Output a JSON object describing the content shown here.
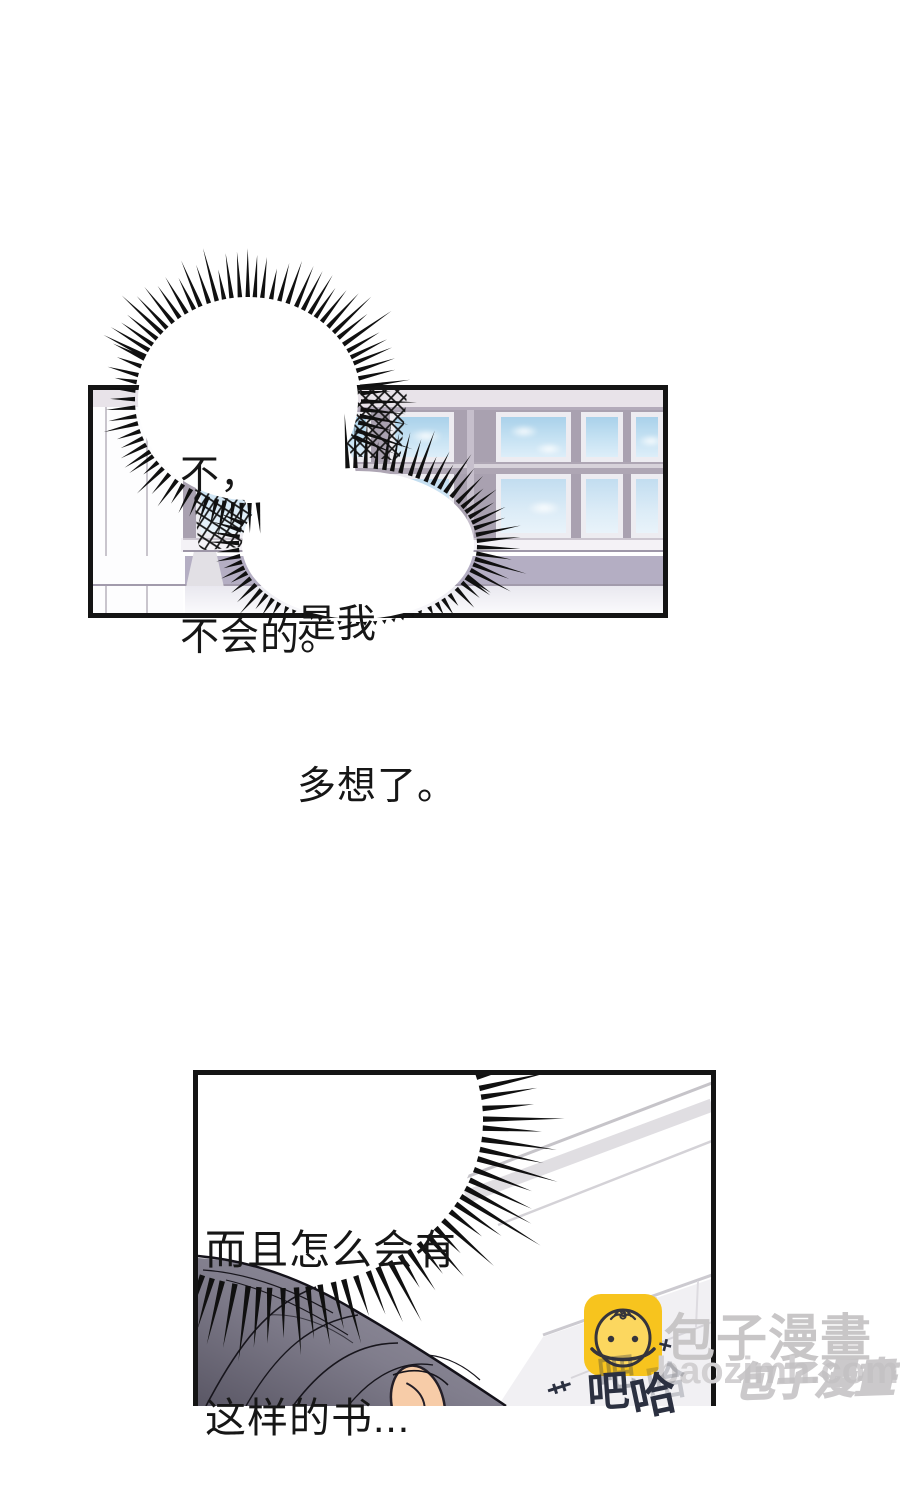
{
  "bubbles": {
    "b1": [
      "不，",
      "不会的。"
    ],
    "b2": [
      "是我",
      "多想了。"
    ],
    "b3": [
      "而且怎么会有",
      "这样的书..."
    ]
  },
  "sfx": {
    "laugh1": "吧",
    "laugh2": "哈",
    "plus_mark": "+",
    "scratch_mark": "艹"
  },
  "watermark": {
    "brand": "包子漫畫",
    "domain": "baozimh.com",
    "overlay": "包子漫畫",
    "icon": "baozi-bun-icon",
    "icon_color": "#f7c41e"
  },
  "colors": {
    "panel_border": "#141414",
    "ink": "#101010",
    "bubble": "#ffffff",
    "wall_light": "#e8e3e9",
    "window_frame": "#a9a1b0",
    "wainscot": "#b4aec3",
    "sky_top": "#a9d1ea",
    "sky_bottom": "#ddeef9",
    "hair_light": "#9b98a6",
    "hair_dark": "#5a5765",
    "skin": "#f7cca8",
    "watermark_gray": "#c8c6c7",
    "sfx_navy": "#2b3040"
  }
}
